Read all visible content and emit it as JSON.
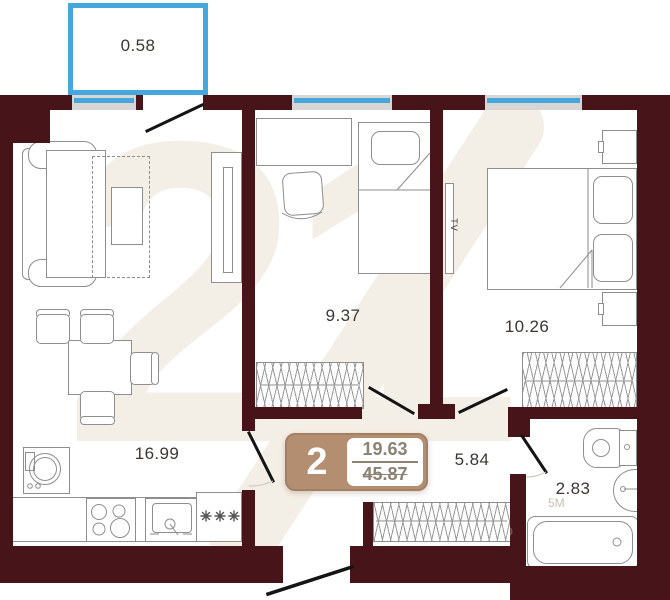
{
  "colors": {
    "wall": "#471519",
    "accent_blue": "#45a7db",
    "window_gray": "#d8d6d4",
    "furniture_line": "#8e8e8e",
    "label": "#3c3733",
    "badge_tan": "#b38e71",
    "badge_border": "#a38063",
    "badge_number": "#8d8173",
    "watermark_cream": "#f4efe6",
    "door_line": "#141414",
    "arc_line": "#cfc8bf"
  },
  "labels": {
    "balcony_area": "0.58",
    "living_room_area": "16.99",
    "bedroom_area": "9.37",
    "master_bedroom_area": "10.26",
    "hallway_area": "5.84",
    "bathroom_area": "2.83",
    "tv": "TV"
  },
  "badge": {
    "rooms": "2",
    "living_area": "19.63",
    "total_area": "45.87"
  },
  "watermark": {
    "logo_number": "21",
    "fragment_area": "5М",
    "fragment_id": "ID"
  }
}
